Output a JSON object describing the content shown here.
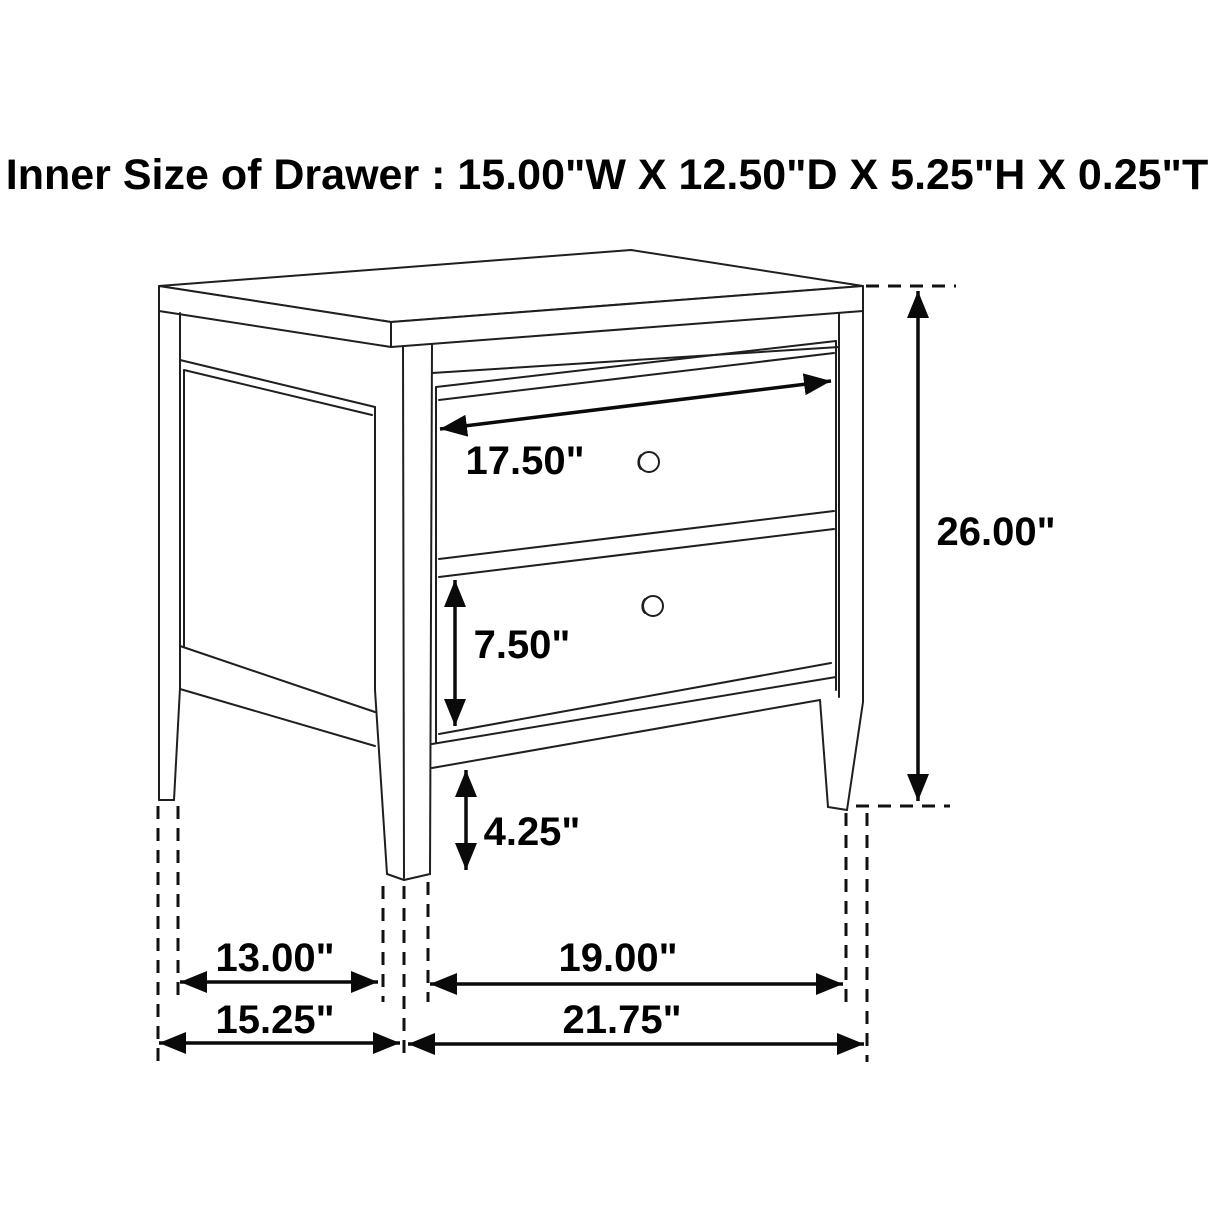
{
  "title": "Inner Size of Drawer : 15.00\"W X 12.50\"D X 5.25\"H X 0.25\"T",
  "figure": {
    "kind": "furniture-dimension-line-drawing",
    "item": "two-drawer nightstand",
    "drawer_count": 2
  },
  "labels": {
    "drawer_front_width": "17.50\"",
    "overall_height": "26.00\"",
    "drawer_face_height": "7.50\"",
    "leg_clearance_height": "4.25\"",
    "side_leg_span": "13.00\"",
    "side_overall_depth": "15.25\"",
    "front_leg_span": "19.00\"",
    "overall_width": "21.75\""
  },
  "inner_drawer_size": {
    "width": "15.00\"",
    "depth": "12.50\"",
    "height": "5.25\"",
    "thickness": "0.25\""
  },
  "colors": {
    "line": "#1f1f1f",
    "text": "#000000",
    "background": "#ffffff"
  }
}
